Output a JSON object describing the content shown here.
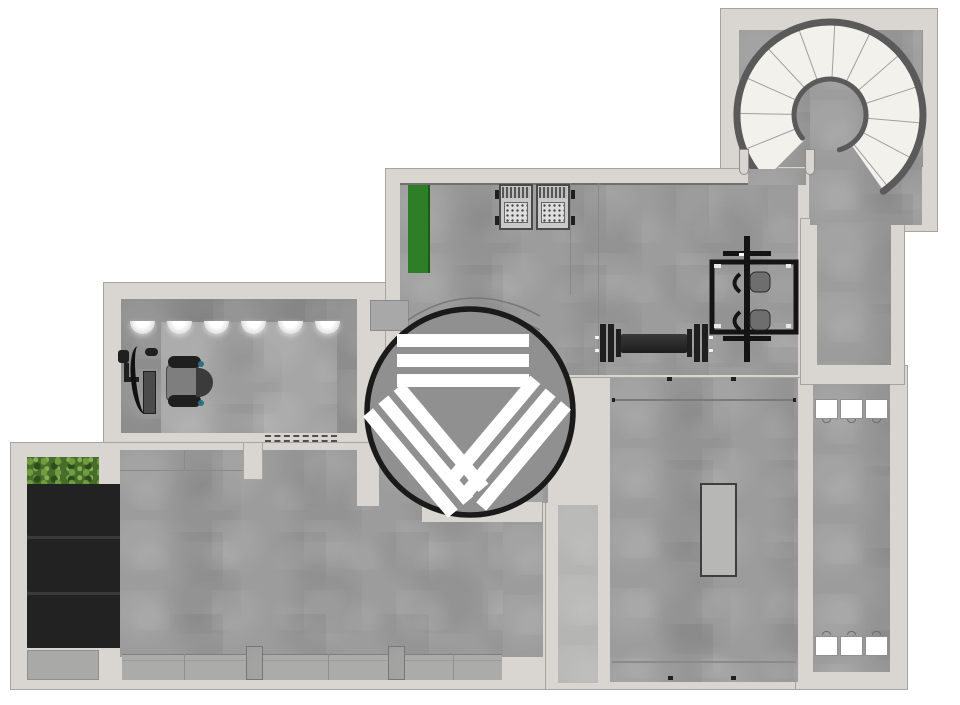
{
  "floorplan": {
    "background": "#ffffff",
    "colors": {
      "wall": "#d9d6d1",
      "wall_line": "#a7a49f",
      "floor": "#9c9c9c",
      "floor_dark": "#8d8d8d",
      "floor_light": "#a6a6a6",
      "corridor": "#b5b5b3",
      "band": "#ababaa",
      "accent_green": "#2e7d27",
      "plant_green": "#466d2a",
      "equipment_black": "#1f1f1f",
      "mat_gray": "#b7b7b6",
      "stripe_white": "#ffffff",
      "logo_ring": "#1a1a1a",
      "stair_rail": "#5a5a5a",
      "stair_tread": "#f2f1ec"
    },
    "rooms": [
      {
        "name": "stair-room",
        "feature": "spiral-staircase"
      },
      {
        "name": "gym-room-top",
        "features": [
          "green-mat",
          "storage-rack",
          "loaded-barbell",
          "power-rack"
        ]
      },
      {
        "name": "office-room",
        "features": [
          "ceiling-lights-row",
          "exercise-machine-with-seat"
        ]
      },
      {
        "name": "storage-nook",
        "features": [
          "planter",
          "black-cabinets"
        ]
      },
      {
        "name": "main-room-bottom-left",
        "features": [
          "window-band",
          "door-threshold",
          "wall-pillars"
        ]
      },
      {
        "name": "room-bottom-right",
        "features": [
          "floor-mat",
          "wall-rails"
        ]
      },
      {
        "name": "narrow-room-right",
        "features": [
          "white-bins-top",
          "white-bins-bottom"
        ]
      },
      {
        "name": "corridor-right"
      }
    ],
    "logo": {
      "shape": "circle-with-triangle-stripes",
      "stripe_groups": 3,
      "stripes_per_group": 3
    },
    "counts": {
      "ceiling_lights": 6,
      "black_cabinets": 3,
      "white_bins_top": 3,
      "white_bins_bottom": 3,
      "stair_treads": 12
    }
  }
}
